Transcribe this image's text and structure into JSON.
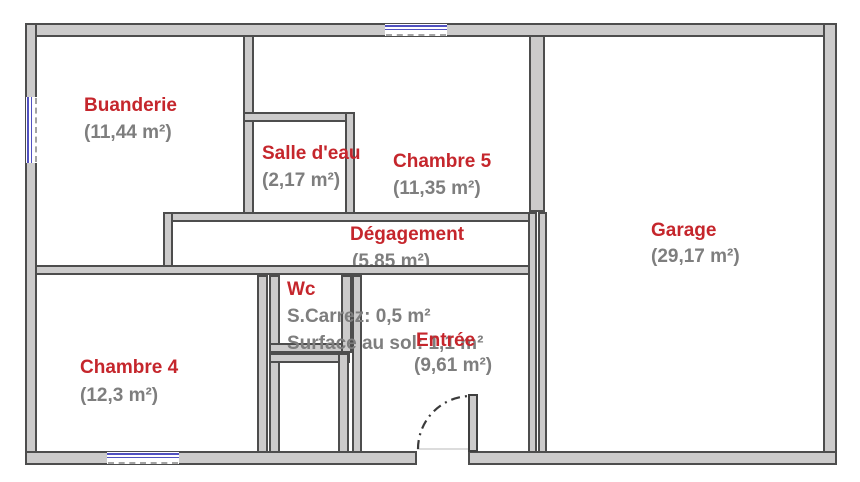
{
  "plan": {
    "rooms": {
      "buanderie": {
        "name": "Buanderie",
        "area": "(11,44 m²)"
      },
      "salle_deau": {
        "name": "Salle d'eau",
        "area": "(2,17 m²)"
      },
      "chambre5": {
        "name": "Chambre 5",
        "area": "(11,35 m²)"
      },
      "degagement": {
        "name": "Dégagement",
        "area": "(5,85 m²)"
      },
      "wc": {
        "name": "Wc",
        "carrez": "S.Carrez: 0,5 m²",
        "surface": "Surface au sol: 1,1 m²"
      },
      "entree": {
        "name": "Entrée",
        "area": "(9,61 m²)"
      },
      "chambre4": {
        "name": "Chambre 4",
        "area": "(12,3 m²)"
      },
      "garage": {
        "name": "Garage",
        "area": "(29,17 m²)"
      }
    },
    "colors": {
      "room_name": "#c5262c",
      "room_area": "#7e7e7e",
      "wall_fill": "#cccbcb",
      "wall_outline": "#4d4d4d",
      "window_glass": "#5151c0"
    }
  }
}
